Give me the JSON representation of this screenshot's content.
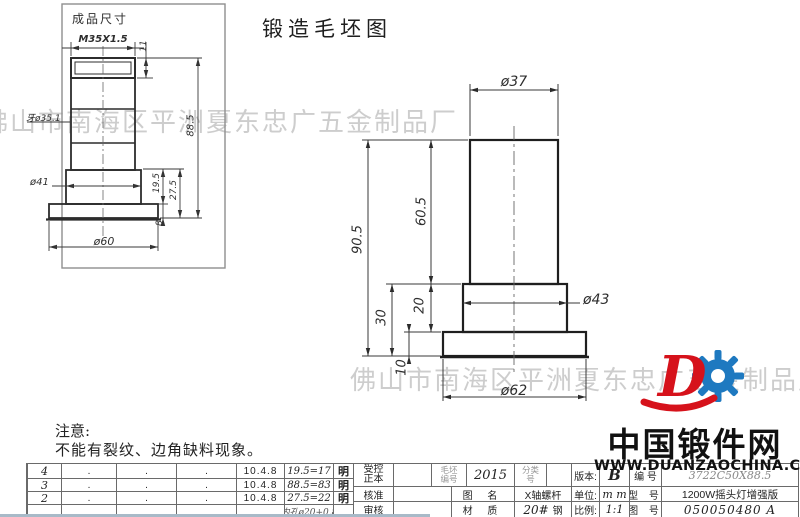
{
  "page_title": "锻造毛坯图",
  "inset": {
    "label": "成品尺寸",
    "thread_spec": "M35X1.5",
    "dim_thread_len": "11",
    "thread_od": "牙ø35.1",
    "dim_overall": "88.5",
    "dim_d41": "ø41",
    "dim_195": "19.5",
    "dim_275": "27.5",
    "dim_8": "8",
    "dim_d60": "ø60"
  },
  "main_view": {
    "dim_d37": "ø37",
    "dim_905": "90.5",
    "dim_605": "60.5",
    "dim_30": "30",
    "dim_20": "20",
    "dim_10": "10",
    "dim_d43": "ø43",
    "dim_d62": "ø62"
  },
  "watermarks": {
    "line1": "佛山市南海区平洲夏东忠广五金制品厂",
    "line2": "佛山市南海区平洲夏东忠广五金制品厂"
  },
  "note": {
    "heading": "注意:",
    "body": "不能有裂纹、边角缺料现象。"
  },
  "logo": {
    "name": "中国锻件网",
    "url": "WWW.DUANZAOCHINA.COM",
    "red": "#d6121b",
    "blue": "#1e79c0"
  },
  "revision_table": {
    "rows": [
      {
        "no": "4",
        "c1": ".",
        "c2": ".",
        "c3": ".",
        "date": "10.4.8",
        "change": "19.5=17",
        "sign": "明"
      },
      {
        "no": "3",
        "c1": ".",
        "c2": ".",
        "c3": ".",
        "date": "10.4.8",
        "change": "88.5=83",
        "sign": "明"
      },
      {
        "no": "2",
        "c1": ".",
        "c2": ".",
        "c3": ".",
        "date": "10.4.8",
        "change": "27.5=22",
        "sign": "明"
      },
      {
        "no": "",
        "c1": "",
        "c2": "",
        "c3": "",
        "date": "",
        "change": "内孔ø20+0.8",
        "sign": ""
      }
    ]
  },
  "title_block": {
    "controlled_l1": "受控",
    "controlled_l2": "正本",
    "approve": "核准",
    "review": "审核",
    "blank_no_l1": "毛坯",
    "blank_no_l2": "编号",
    "blank_no_value": "2015",
    "class_no_l1": "分类",
    "class_no_l2": "号",
    "version_label": "版本:",
    "version_value": "B",
    "serial_label": "编 号",
    "serial_value": "3722C50X88.5",
    "name_label": "图 名",
    "name_value": "X轴螺杆",
    "unit_label": "单位:",
    "unit_value": "m m",
    "model_label": "型 号",
    "model_value": "1200W摇头灯增强版",
    "material_label": "材 质",
    "material_value_num": "20#",
    "material_value_text": "钢",
    "scale_label": "比例:",
    "scale_value": "1:1",
    "dwg_no_label": "图 号",
    "dwg_no_value": "050050480  A"
  }
}
